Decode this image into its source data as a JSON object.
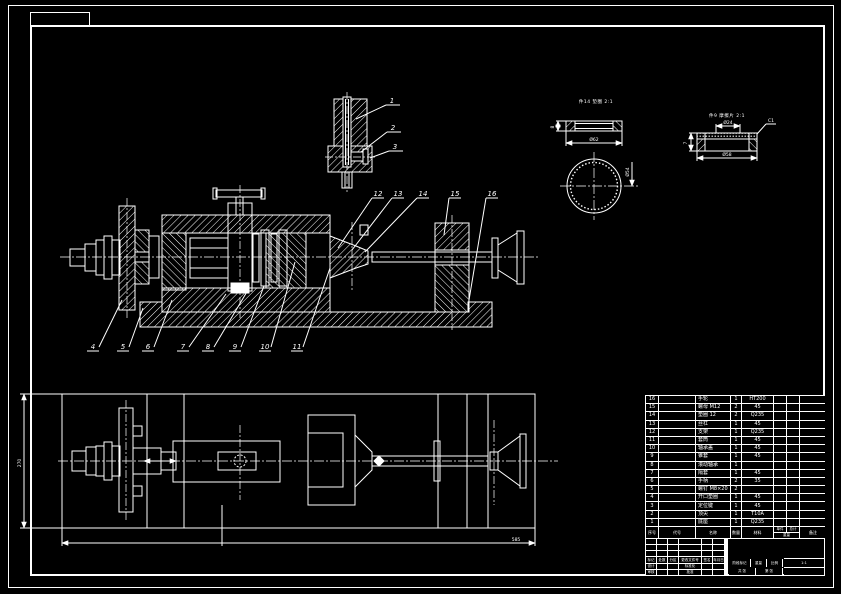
{
  "sheet": {
    "background": "#000000",
    "line_color": "#ffffff"
  },
  "callouts": {
    "detail": [
      "1",
      "2",
      "3"
    ],
    "bottom": [
      "4",
      "5",
      "6",
      "7",
      "8",
      "9",
      "10",
      "11"
    ],
    "top": [
      "12",
      "13",
      "14",
      "15",
      "16"
    ]
  },
  "details": {
    "a_label": "件14 垫圈 2:1",
    "b_label": "件9 摩擦片 2:1"
  },
  "dims": {
    "a_od": "Ø62",
    "a_t": "8",
    "a_id": "Ø54",
    "b_top": "Ø24",
    "b_bot": "Ø58",
    "b_t": "7",
    "b_ch": "C1",
    "plan_len": "585",
    "plan_wid": "270"
  },
  "bom": {
    "headers": {
      "no": "序号",
      "code": "代号",
      "name": "名称",
      "qty": "数量",
      "mat": "材料",
      "unit": "单件",
      "total": "总计",
      "wt": "重量",
      "note": "备注"
    },
    "rows": [
      [
        "16",
        "",
        "手轮",
        "1",
        "HT200",
        "",
        "",
        ""
      ],
      [
        "15",
        "",
        "螺母 M12",
        "2",
        "45",
        "",
        "",
        ""
      ],
      [
        "14",
        "",
        "垫圈 12",
        "2",
        "Q235",
        "",
        "",
        ""
      ],
      [
        "13",
        "",
        "丝杠",
        "1",
        "45",
        "",
        "",
        ""
      ],
      [
        "12",
        "",
        "支架",
        "1",
        "Q235",
        "",
        "",
        ""
      ],
      [
        "11",
        "",
        "套筒",
        "1",
        "45",
        "",
        "",
        ""
      ],
      [
        "10",
        "",
        "轴承盖",
        "1",
        "45",
        "",
        "",
        ""
      ],
      [
        "9",
        "",
        "锥套",
        "1",
        "45",
        "",
        "",
        ""
      ],
      [
        "8",
        "",
        "滚动轴承",
        "1",
        "",
        "",
        "",
        ""
      ],
      [
        "7",
        "",
        "隔套",
        "1",
        "45",
        "",
        "",
        ""
      ],
      [
        "6",
        "",
        "手柄",
        "2",
        "35",
        "",
        "",
        ""
      ],
      [
        "5",
        "",
        "螺钉 M8×20",
        "2",
        "",
        "",
        "",
        ""
      ],
      [
        "4",
        "",
        "开口垫圈",
        "1",
        "45",
        "",
        "",
        ""
      ],
      [
        "3",
        "",
        "定位键",
        "1",
        "45",
        "",
        "",
        ""
      ],
      [
        "2",
        "",
        "顶尖",
        "1",
        "T10A",
        "",
        "",
        ""
      ],
      [
        "1",
        "",
        "底座",
        "1",
        "Q235",
        "",
        "",
        ""
      ]
    ]
  },
  "titleblock": {
    "mark": "标记",
    "count": "处数",
    "zone": "分区",
    "doc": "更改文件号",
    "sign": "签名",
    "date": "年月日",
    "design": "设计",
    "standard": "标准化",
    "check": "审核",
    "approve": "批准",
    "stage": "阶段标记",
    "weight": "重量",
    "scale": "比例",
    "scale_val": "1:1",
    "sheets": "共 张",
    "page": "第 张"
  }
}
